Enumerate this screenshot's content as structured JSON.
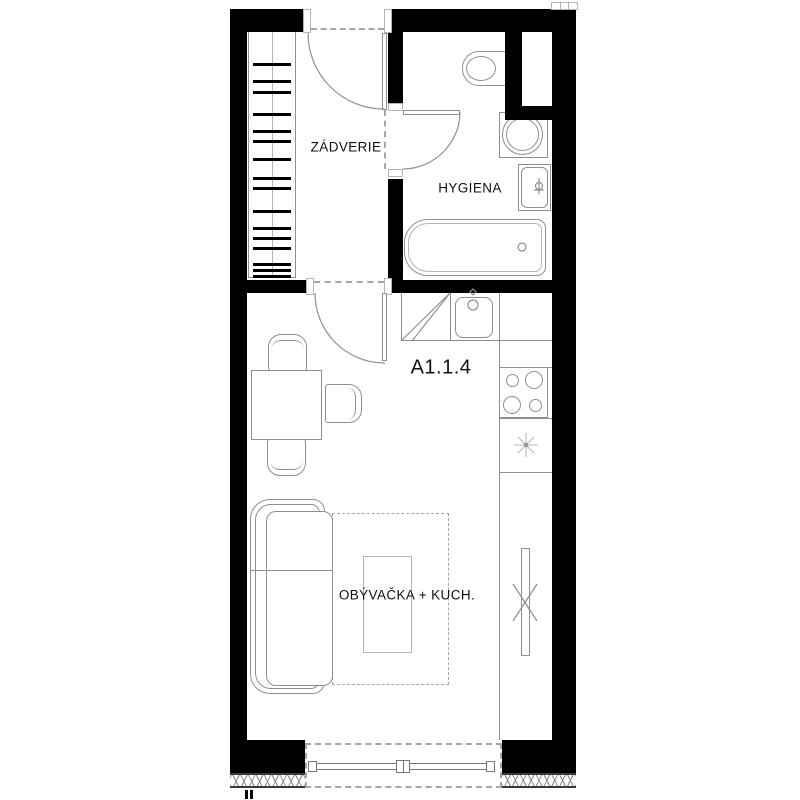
{
  "unit": {
    "label": "A1.1.4"
  },
  "rooms": [
    {
      "id": "zadverie",
      "label": "ZÁDVERIE"
    },
    {
      "id": "hygiena",
      "label": "HYGIENA"
    },
    {
      "id": "obyvacka_kuchyna",
      "label": "OBÝVAČKA + KUCH."
    }
  ],
  "fixtures": [
    "wardrobe-hangers",
    "entrance-door",
    "bathroom-door",
    "living-room-door",
    "toilet",
    "washing-machine",
    "washbasin",
    "bathtub",
    "shaft",
    "kitchen-counter",
    "tall-cabinet",
    "kitchen-sink",
    "cooktop",
    "boiler-symbol",
    "radiator",
    "dining-table",
    "chairs",
    "sofa",
    "coffee-table",
    "rug",
    "balcony-window",
    "insulation-hatch",
    "section-marks"
  ],
  "wardrobe": {
    "bar_count": 16,
    "bar_y": [
      62,
      79,
      90,
      112,
      129,
      139,
      157,
      176,
      186,
      209,
      226,
      236,
      246,
      262,
      268,
      274
    ]
  },
  "colors": {
    "wall": "#000000",
    "line": "#8f8f8f",
    "line_light": "#b4b4b4",
    "dash": "#a6a6a6",
    "text": "#111111"
  }
}
